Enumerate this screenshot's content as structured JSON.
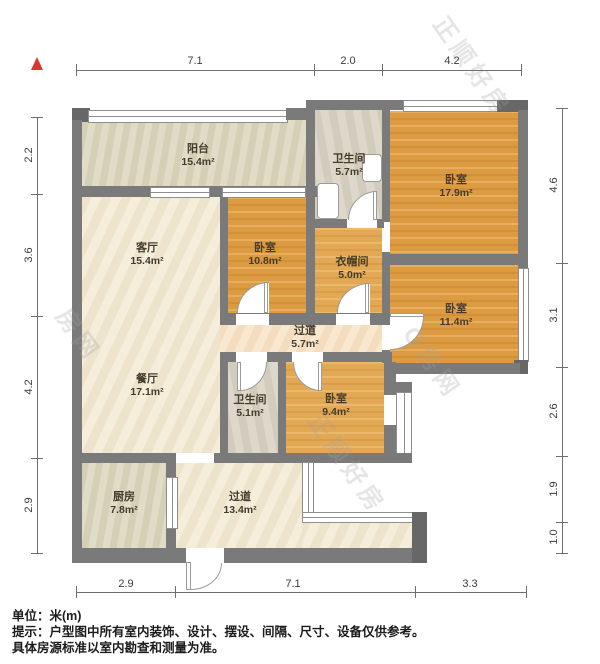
{
  "rooms": [
    {
      "name": "阳台",
      "area": "15.4m²"
    },
    {
      "name": "卫生间",
      "area": "5.7m²"
    },
    {
      "name": "卧室",
      "area": "17.9m²"
    },
    {
      "name": "客厅",
      "area": "15.4m²"
    },
    {
      "name": "卧室",
      "area": "10.8m²"
    },
    {
      "name": "衣帽间",
      "area": "5.0m²"
    },
    {
      "name": "过道",
      "area": "5.7m²"
    },
    {
      "name": "卧室",
      "area": "11.4m²"
    },
    {
      "name": "餐厅",
      "area": "17.1m²"
    },
    {
      "name": "卫生间",
      "area": "5.1m²"
    },
    {
      "name": "卧室",
      "area": "9.4m²"
    },
    {
      "name": "厨房",
      "area": "7.8m²"
    },
    {
      "name": "过道",
      "area": "13.4m²"
    }
  ],
  "dimensions": {
    "top": [
      {
        "value": "7.1"
      },
      {
        "value": "2.0"
      },
      {
        "value": "4.2"
      }
    ],
    "left": [
      {
        "value": "2.2"
      },
      {
        "value": "3.6"
      },
      {
        "value": "4.2"
      },
      {
        "value": "2.9"
      }
    ],
    "right": [
      {
        "value": "4.6"
      },
      {
        "value": "3.1"
      },
      {
        "value": "2.6"
      },
      {
        "value": "1.9"
      },
      {
        "value": "1.0"
      }
    ],
    "bottom": [
      {
        "value": "2.9"
      },
      {
        "value": "7.1"
      },
      {
        "value": "3.3"
      }
    ]
  },
  "footer": {
    "line1": "单位：米(m)",
    "line2": "提示：户型图中所有室内装饰、设计、摆设、间隔、尺寸、设备仅供参考。",
    "line3": "具体房源标准以室内勘查和测量为准。"
  },
  "watermark": {
    "fragments": [
      "正顺好房",
      "O房网",
      "正顺好房",
      "房网"
    ]
  },
  "colors": {
    "wall": "#7a7a7a",
    "wood": "#dd9b41",
    "cream": "#f2e9d4",
    "accent_red": "#d63a2f"
  }
}
